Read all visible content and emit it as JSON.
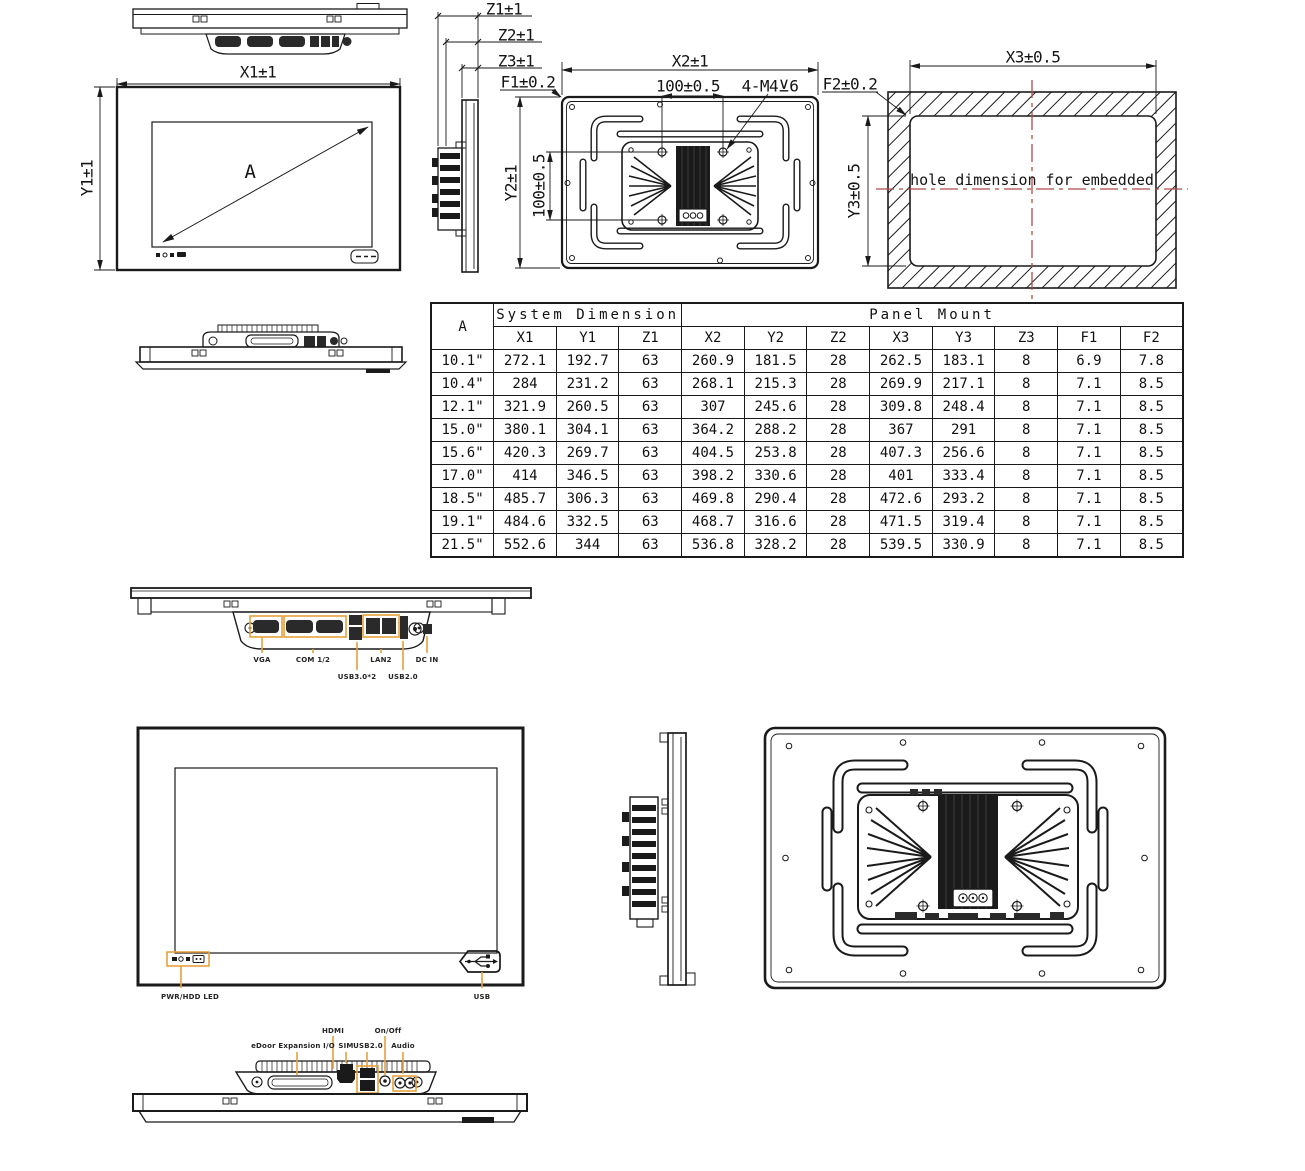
{
  "colors": {
    "line": "#1a1a1a",
    "highlight": "#e6a23c",
    "centerline": "#b14b4b"
  },
  "annotations": {
    "x1": "X1±1",
    "y1": "Y1±1",
    "z1": "Z1±1",
    "z2": "Z2±1",
    "z3": "Z3±1",
    "f1": "F1±0.2",
    "x2": "X2±1",
    "vesa_h": "100±0.5",
    "screws": "4-M4⊻6",
    "f2": "F2±0.2",
    "x3": "X3±0.5",
    "y2": "Y2±1",
    "vesa_v": "100±0.5",
    "y3": "Y3±0.5",
    "diagonal": "A",
    "hole_note": "hole dimension for embedded"
  },
  "table": {
    "corner_header": "A",
    "group_headers": [
      "System Dimension",
      "Panel Mount"
    ],
    "sub_headers": [
      "X1",
      "Y1",
      "Z1",
      "X2",
      "Y2",
      "Z2",
      "X3",
      "Y3",
      "Z3",
      "F1",
      "F2"
    ],
    "rows": [
      [
        "10.1\"",
        "272.1",
        "192.7",
        "63",
        "260.9",
        "181.5",
        "28",
        "262.5",
        "183.1",
        "8",
        "6.9",
        "7.8"
      ],
      [
        "10.4\"",
        "284",
        "231.2",
        "63",
        "268.1",
        "215.3",
        "28",
        "269.9",
        "217.1",
        "8",
        "7.1",
        "8.5"
      ],
      [
        "12.1\"",
        "321.9",
        "260.5",
        "63",
        "307",
        "245.6",
        "28",
        "309.8",
        "248.4",
        "8",
        "7.1",
        "8.5"
      ],
      [
        "15.0\"",
        "380.1",
        "304.1",
        "63",
        "364.2",
        "288.2",
        "28",
        "367",
        "291",
        "8",
        "7.1",
        "8.5"
      ],
      [
        "15.6\"",
        "420.3",
        "269.7",
        "63",
        "404.5",
        "253.8",
        "28",
        "407.3",
        "256.6",
        "8",
        "7.1",
        "8.5"
      ],
      [
        "17.0\"",
        "414",
        "346.5",
        "63",
        "398.2",
        "330.6",
        "28",
        "401",
        "333.4",
        "8",
        "7.1",
        "8.5"
      ],
      [
        "18.5\"",
        "485.7",
        "306.3",
        "63",
        "469.8",
        "290.4",
        "28",
        "472.6",
        "293.2",
        "8",
        "7.1",
        "8.5"
      ],
      [
        "19.1\"",
        "484.6",
        "332.5",
        "63",
        "468.7",
        "316.6",
        "28",
        "471.5",
        "319.4",
        "8",
        "7.1",
        "8.5"
      ],
      [
        "21.5\"",
        "552.6",
        "344",
        "63",
        "536.8",
        "328.2",
        "28",
        "539.5",
        "330.9",
        "8",
        "7.1",
        "8.5"
      ]
    ]
  },
  "io_panel_front": {
    "labels": [
      "VGA",
      "COM 1/2",
      "USB3.0*2",
      "LAN2",
      "USB2.0",
      "DC IN"
    ]
  },
  "front_panel": {
    "led_label": "PWR/HDD LED",
    "usb_label": "USB"
  },
  "io_panel_rear": {
    "labels": [
      "eDoor Expansion I/O",
      "HDMI",
      "SIM",
      "USB2.0",
      "On/Off",
      "Audio"
    ]
  }
}
